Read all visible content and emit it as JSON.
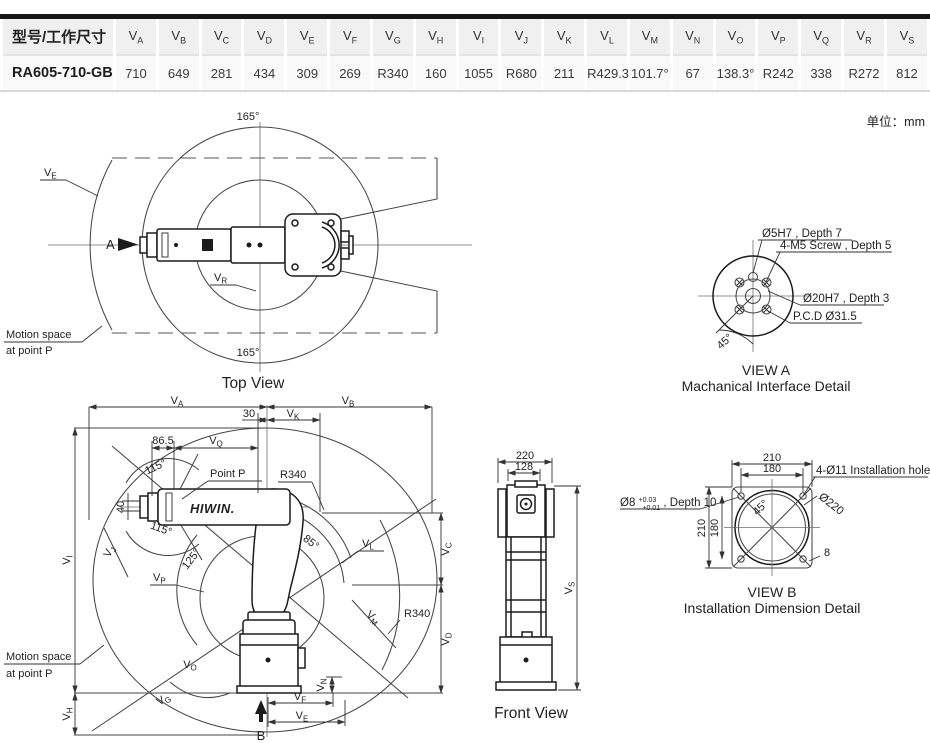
{
  "unit_note": "单位：mm",
  "colors": {
    "accent_green": "#2fa25c",
    "line": "#454545",
    "robot_line": "#1c1c1c",
    "table_top_border": "#161616",
    "table_header_bg": "#f0f0f0",
    "table_row_bg": "#f9f9f9"
  },
  "table": {
    "header_col0": "型号/工作尺寸",
    "model": "RA605-710-GB",
    "columns_prefix": "V",
    "columns": [
      "A",
      "B",
      "C",
      "D",
      "E",
      "F",
      "G",
      "H",
      "I",
      "J",
      "K",
      "L",
      "M",
      "N",
      "O",
      "P",
      "Q",
      "R",
      "S"
    ],
    "values": [
      "710",
      "649",
      "281",
      "434",
      "309",
      "269",
      "R340",
      "160",
      "1055",
      "R680",
      "211",
      "R429.3",
      "101.7°",
      "67",
      "138.3°",
      "R242",
      "338",
      "R272",
      "812"
    ]
  },
  "dims": {
    "VA": {
      "main": "V",
      "sub": "A"
    },
    "VB": {
      "main": "V",
      "sub": "B"
    },
    "VC": {
      "main": "V",
      "sub": "C"
    },
    "VD": {
      "main": "V",
      "sub": "D"
    },
    "VE": {
      "main": "V",
      "sub": "E"
    },
    "VF": {
      "main": "V",
      "sub": "F"
    },
    "VG": {
      "main": "V",
      "sub": "G"
    },
    "VH": {
      "main": "V",
      "sub": "H"
    },
    "VI": {
      "main": "V",
      "sub": "I"
    },
    "VJ": {
      "main": "V",
      "sub": "J"
    },
    "VK": {
      "main": "V",
      "sub": "K"
    },
    "VL": {
      "main": "V",
      "sub": "L"
    },
    "VM": {
      "main": "V",
      "sub": "M"
    },
    "VN": {
      "main": "V",
      "sub": "N"
    },
    "VO": {
      "main": "V",
      "sub": "O"
    },
    "VP": {
      "main": "V",
      "sub": "P"
    },
    "VQ": {
      "main": "V",
      "sub": "Q"
    },
    "VR": {
      "main": "V",
      "sub": "R"
    },
    "VS": {
      "main": "V",
      "sub": "S"
    }
  },
  "top_view": {
    "caption": "Top View",
    "angle_top": "165°",
    "angle_bottom": "165°",
    "view_arrow": "A",
    "motion_space_1": "Motion space",
    "motion_space_2": "at point P"
  },
  "elevation": {
    "dim_30": "30",
    "dim_86_5": "86.5",
    "dim_40": "40",
    "angle_115_top": "115°",
    "angle_115_bottom": "115°",
    "angle_125": "125°",
    "angle_85": "85°",
    "point_p": "Point P",
    "r340_upper": "R340",
    "r340_lower": "R340",
    "view_arrow": "B",
    "motion_space_1": "Motion space",
    "motion_space_2": "at point P",
    "logo": "HIWIN."
  },
  "front_view": {
    "caption": "Front View",
    "dim_220": "220",
    "dim_128": "128"
  },
  "view_a": {
    "caption_line1": "VIEW A",
    "caption_line2": "Machanical Interface Detail",
    "note_pin": "Ø5H7 , Depth 7",
    "note_screws": "4-M5 Screw , Depth 5",
    "note_bore": "Ø20H7 , Depth 3",
    "note_pcd": "P.C.D Ø31.5",
    "angle_45": "45°"
  },
  "view_b": {
    "caption_line1": "VIEW B",
    "caption_line2": "Installation Dimension Detail",
    "dim_210_top": "210",
    "dim_180_top": "180",
    "dim_210_left": "210",
    "dim_180_left": "180",
    "note_holes": "4-Ø11 Installation hole",
    "note_dia220": "Ø220",
    "pin_main": "Ø8",
    "pin_tol_upper": "+0.03",
    "pin_tol_lower": "+0.01",
    "pin_suffix": " , Depth 10",
    "angle_45": "45°",
    "dim_8": "8"
  }
}
